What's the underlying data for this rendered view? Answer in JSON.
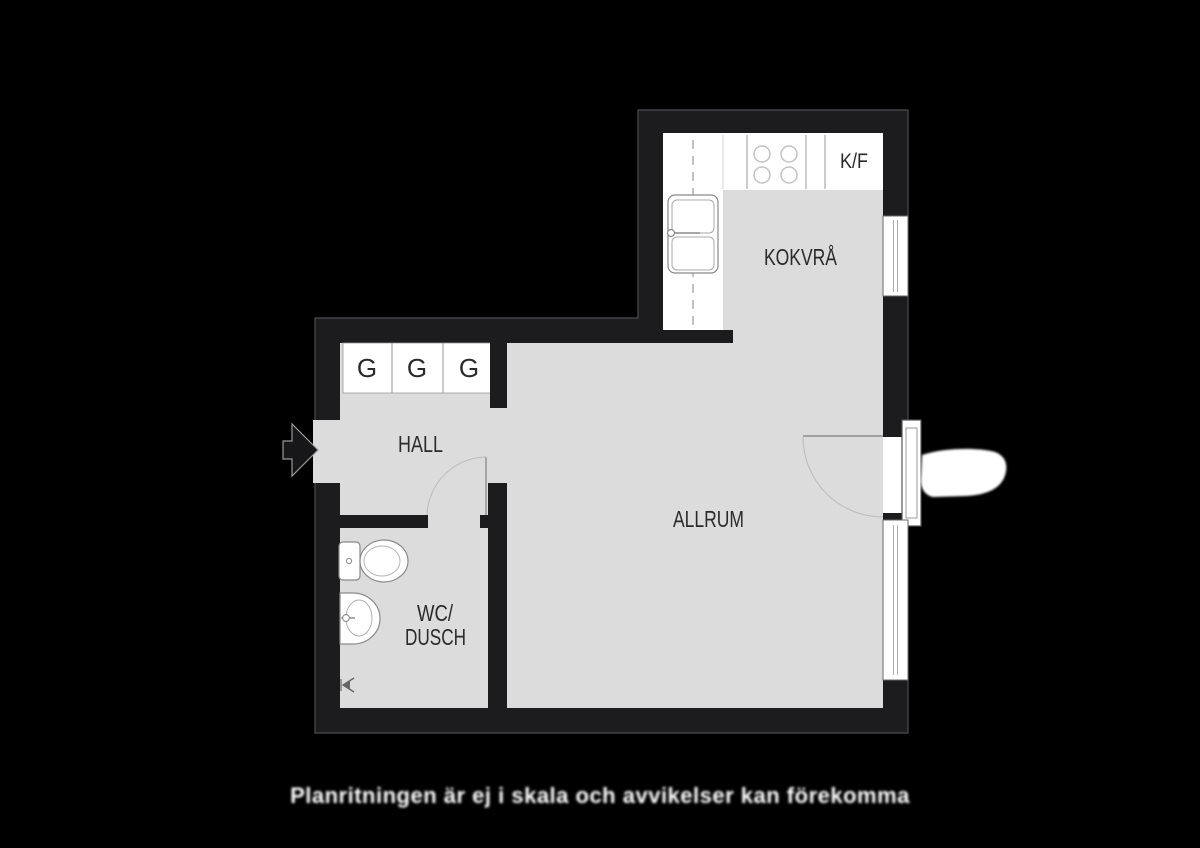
{
  "colors": {
    "background": "#000000",
    "wall": "#1c1c1f",
    "wall_outline": "#4d4d52",
    "floor": "#dcdcdd",
    "fixture_fill": "#ffffff",
    "fixture_line": "#8a8a8a",
    "label_text": "#2a2a2a",
    "caption_text": "#ffffff"
  },
  "labels": {
    "hall": "HALL",
    "wc_line1": "WC/",
    "wc_line2": "DUSCH",
    "allrum": "ALLRUM",
    "kokvra": "KOKVRÅ",
    "fridge_freezer": "K/F",
    "wardrobes": [
      "G",
      "G",
      "G"
    ]
  },
  "caption": {
    "text": "Planritningen är ej i skala och avvikelser kan förekomma"
  },
  "icons": [
    "entrance-arrow-icon",
    "stove-icon",
    "kitchen-sink-icon",
    "fridge-freezer-compartment",
    "wardrobe-cabinet",
    "toilet-icon",
    "washbasin-icon",
    "floor-drain-icon",
    "window-icon",
    "door-swing-icon",
    "balcony-shape"
  ]
}
